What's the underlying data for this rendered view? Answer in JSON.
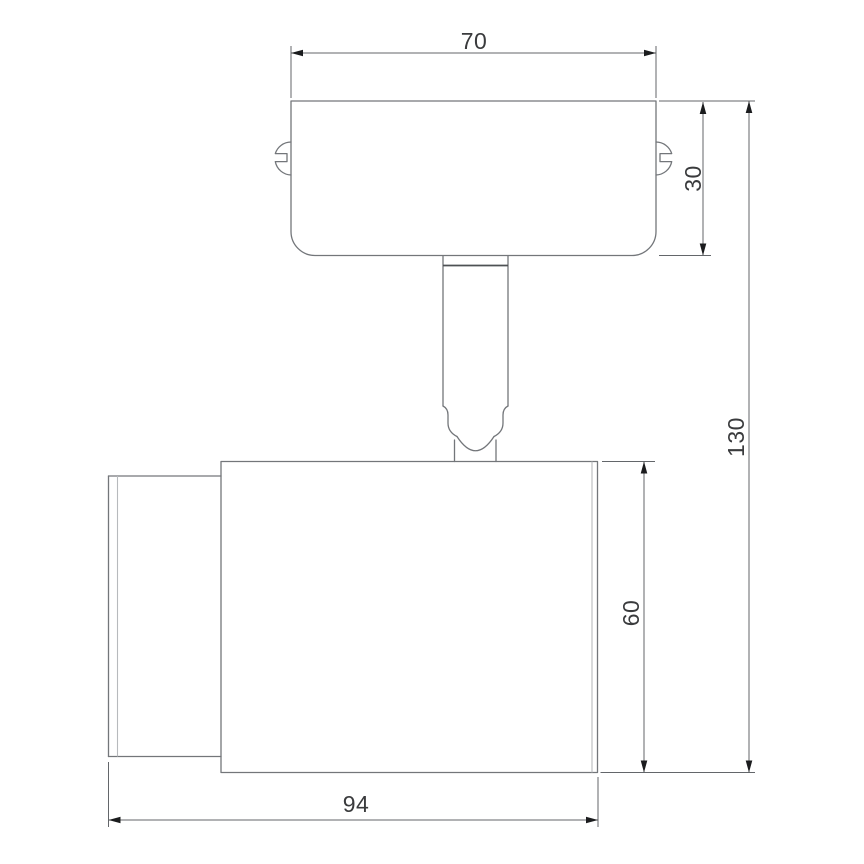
{
  "colors": {
    "background": "#ffffff",
    "outline": "#73767a",
    "inner_line": "#b7babd",
    "accent_line": "#4e5154",
    "dimension_line": "#63666a",
    "arrow": "#1b1c1e",
    "text": "#3a3b3d"
  },
  "dimensions": {
    "top_width": "70",
    "plate_height": "30",
    "total_height": "130",
    "body_height": "60",
    "body_length": "94"
  }
}
